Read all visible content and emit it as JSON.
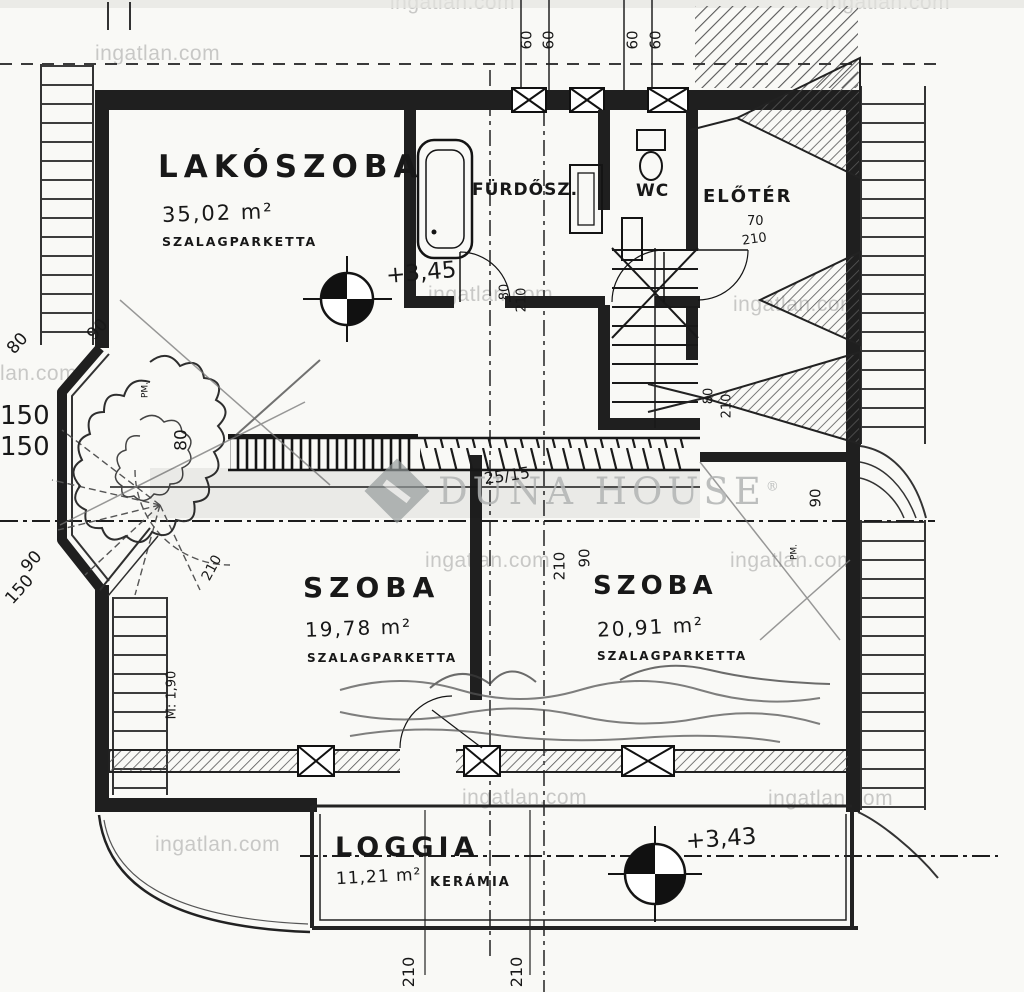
{
  "watermark": {
    "site": "ingatlan.com",
    "brand": "DUNA HOUSE",
    "reg": "®"
  },
  "rooms": {
    "lakoszoba": {
      "name": "LAKÓSZOBA",
      "area": "35,02 m²",
      "floor": "SZALAGPARKETTA"
    },
    "furdoszoba": {
      "name": "FÜRDŐSZ."
    },
    "wc": {
      "name": "WC"
    },
    "eloter": {
      "name": "ELŐTÉR"
    },
    "szoba1": {
      "name": "SZOBA",
      "area": "19,78 m²",
      "floor": "SZALAGPARKETTA"
    },
    "szoba2": {
      "name": "SZOBA",
      "area": "20,91 m²",
      "floor": "SZALAGPARKETTA"
    },
    "loggia": {
      "name": "LOGGIA",
      "area": "11,21 m²",
      "floor": "KERÁMIA"
    }
  },
  "levels": {
    "upper": "+3,45",
    "loggia": "+3,43"
  },
  "dims": {
    "top_60_1": "60",
    "top_60_2": "60",
    "top_60_3": "60",
    "top_60_4": "60",
    "left_90": "90",
    "left_80": "80",
    "left_150_1": "150",
    "left_150_2": "150",
    "left2_90": "90",
    "left2_150": "150",
    "rail_80": "80",
    "bath_door_80": "80",
    "bath_door_210": "210",
    "eloter_70": "70",
    "eloter_210": "210",
    "eloter_door_80": "80",
    "eloter_door_210": "210",
    "mid_90": "90",
    "mid_210": "210",
    "right_90": "90",
    "winder_210": "210",
    "pm_left": "PM.",
    "pm_right": "PM.",
    "height_note": "M: 1,90",
    "note_frac": "25/15",
    "bottom_210_1": "210",
    "bottom_210_2": "210"
  }
}
